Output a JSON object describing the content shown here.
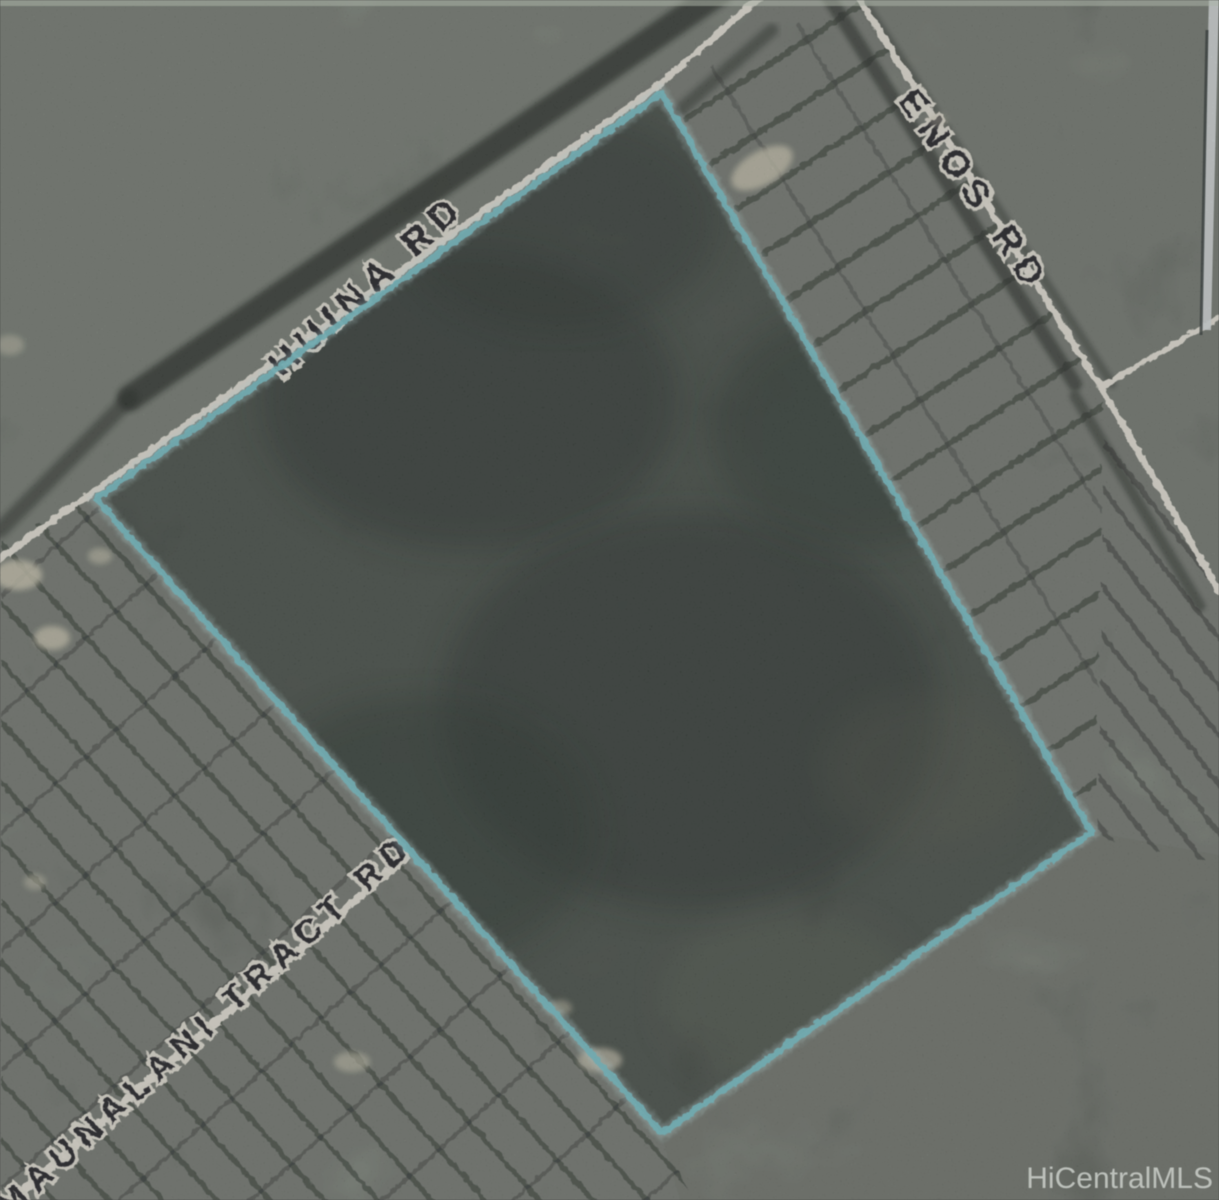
{
  "map": {
    "description": "Scanned aerial satellite map of a land parcel outlined in cyan",
    "watermark": {
      "text": "HiCentralMLS",
      "color": "#c6cbc5"
    },
    "labels": {
      "huina_rd": "HUINA RD",
      "enos_rd": "ENOS RD",
      "maunalani_tract_rd": "MAUNALANI TRACT RD"
    },
    "parcel": {
      "outline_color": "#67cad3",
      "corners_px": [
        [
          660,
          92
        ],
        [
          1090,
          831
        ],
        [
          661,
          1132
        ],
        [
          95,
          498
        ]
      ]
    },
    "roads": [
      {
        "name": "HUINA RD",
        "path_px": [
          [
            -15,
            567
          ],
          [
            90,
            492
          ],
          [
            655,
            86
          ],
          [
            768,
            -12
          ]
        ]
      },
      {
        "name": "ENOS RD",
        "path_px": [
          [
            852,
            -12
          ],
          [
            1098,
            383
          ],
          [
            1224,
            600
          ]
        ]
      },
      {
        "name": "ENOS RD spur",
        "path_px": [
          [
            1100,
            386
          ],
          [
            1222,
            314
          ]
        ]
      },
      {
        "name": "MAUNALANI TRACT RD",
        "path_px": [
          [
            -18,
            1224
          ],
          [
            404,
            856
          ]
        ]
      }
    ],
    "colors": {
      "terrain_base": "#6e7a6b",
      "terrain_light": "#8a9285",
      "terrain_dark": "#2a352c",
      "road": "#ece7da",
      "label_text": "#12121c",
      "shadow": "#141c16",
      "light_patch": "#cfc9ae"
    }
  }
}
